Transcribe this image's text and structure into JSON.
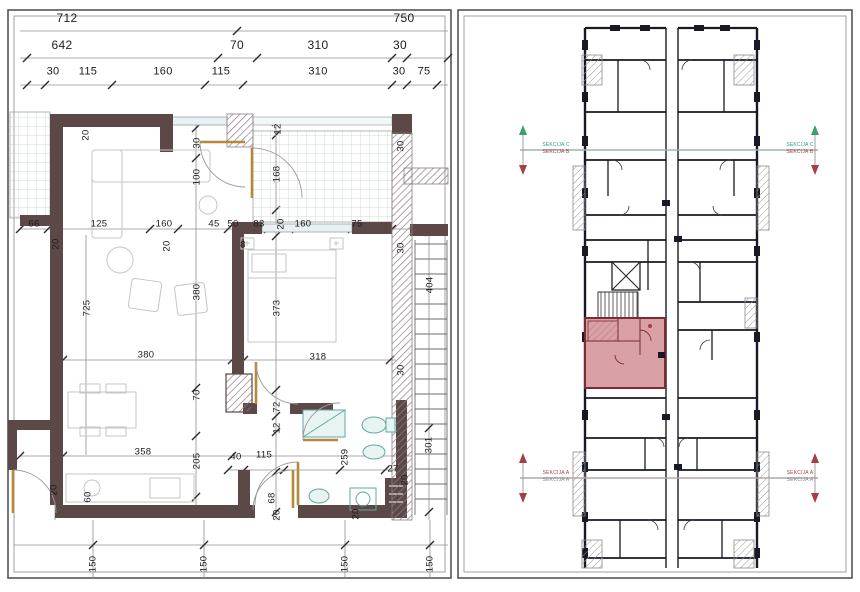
{
  "page": {
    "background": "#ffffff",
    "type": "architectural-floor-plan"
  },
  "colors": {
    "wall_dark": "#5c4847",
    "hatch_line": "#8d7d86",
    "window_fill": "#e8f1f3",
    "door_tan": "#b5883a",
    "fixture_teal": "#5fa8a0",
    "furniture_gray": "#c6c6c6",
    "dim_text": "#1c1c1c",
    "building_wall": "#191925",
    "highlight_fill": "#d9a1a6",
    "highlight_border": "#7c2b33",
    "section_teal": "#2f9a8c",
    "section_red": "#a43f47"
  },
  "left_panel": {
    "name": "apartment-floor-plan",
    "labels": [
      {
        "t": "712",
        "x": 67,
        "y": 18,
        "fs": 12
      },
      {
        "t": "750",
        "x": 404,
        "y": 18,
        "fs": 12
      },
      {
        "t": "642",
        "x": 62,
        "y": 45,
        "fs": 12
      },
      {
        "t": "70",
        "x": 237,
        "y": 45,
        "fs": 12
      },
      {
        "t": "310",
        "x": 318,
        "y": 45,
        "fs": 12
      },
      {
        "t": "30",
        "x": 400,
        "y": 45,
        "fs": 12
      },
      {
        "t": "30",
        "x": 53,
        "y": 72,
        "fs": 11
      },
      {
        "t": "115",
        "x": 88,
        "y": 72,
        "fs": 11
      },
      {
        "t": "160",
        "x": 163,
        "y": 72,
        "fs": 11
      },
      {
        "t": "115",
        "x": 221,
        "y": 72,
        "fs": 11
      },
      {
        "t": "310",
        "x": 318,
        "y": 72,
        "fs": 11
      },
      {
        "t": "30",
        "x": 399,
        "y": 72,
        "fs": 11
      },
      {
        "t": "75",
        "x": 424,
        "y": 72,
        "fs": 11
      },
      {
        "t": "20",
        "x": 86,
        "y": 135,
        "r": 1
      },
      {
        "t": "12",
        "x": 278,
        "y": 129,
        "r": 1
      },
      {
        "t": "30",
        "x": 401,
        "y": 146,
        "r": 1
      },
      {
        "t": "30",
        "x": 197,
        "y": 143,
        "r": 1
      },
      {
        "t": "100",
        "x": 197,
        "y": 177,
        "r": 1
      },
      {
        "t": "168",
        "x": 277,
        "y": 174,
        "r": 1
      },
      {
        "t": "66",
        "x": 34,
        "y": 224
      },
      {
        "t": "125",
        "x": 99,
        "y": 224
      },
      {
        "t": "160",
        "x": 164,
        "y": 224
      },
      {
        "t": "45",
        "x": 214,
        "y": 224
      },
      {
        "t": "50",
        "x": 233,
        "y": 224
      },
      {
        "t": "83",
        "x": 259,
        "y": 224
      },
      {
        "t": "20",
        "x": 281,
        "y": 224,
        "r": 1
      },
      {
        "t": "160",
        "x": 303,
        "y": 224
      },
      {
        "t": "75",
        "x": 357,
        "y": 224
      },
      {
        "t": "8",
        "x": 243,
        "y": 245
      },
      {
        "t": "20",
        "x": 56,
        "y": 244,
        "r": 1
      },
      {
        "t": "20",
        "x": 167,
        "y": 246,
        "r": 1
      },
      {
        "t": "30",
        "x": 401,
        "y": 248,
        "r": 1
      },
      {
        "t": "725",
        "x": 87,
        "y": 308,
        "r": 1
      },
      {
        "t": "380",
        "x": 197,
        "y": 292,
        "r": 1
      },
      {
        "t": "373",
        "x": 277,
        "y": 308,
        "r": 1
      },
      {
        "t": "404",
        "x": 430,
        "y": 285,
        "r": 1
      },
      {
        "t": "380",
        "x": 146,
        "y": 355
      },
      {
        "t": "318",
        "x": 318,
        "y": 357
      },
      {
        "t": "30",
        "x": 401,
        "y": 370,
        "r": 1
      },
      {
        "t": "70",
        "x": 197,
        "y": 395,
        "r": 1
      },
      {
        "t": "72",
        "x": 277,
        "y": 407,
        "r": 1
      },
      {
        "t": "12",
        "x": 277,
        "y": 428,
        "r": 1
      },
      {
        "t": "358",
        "x": 143,
        "y": 452
      },
      {
        "t": "205",
        "x": 197,
        "y": 461,
        "r": 1
      },
      {
        "t": "40",
        "x": 236,
        "y": 457
      },
      {
        "t": "115",
        "x": 264,
        "y": 455
      },
      {
        "t": "259",
        "x": 345,
        "y": 457,
        "r": 1
      },
      {
        "t": "27",
        "x": 393,
        "y": 469
      },
      {
        "t": "301",
        "x": 429,
        "y": 445,
        "r": 1
      },
      {
        "t": "20",
        "x": 405,
        "y": 480,
        "r": 1
      },
      {
        "t": "20",
        "x": 54,
        "y": 490,
        "r": 1
      },
      {
        "t": "60",
        "x": 88,
        "y": 497,
        "r": 1
      },
      {
        "t": "68",
        "x": 272,
        "y": 498,
        "r": 1
      },
      {
        "t": "20",
        "x": 277,
        "y": 515,
        "r": 1
      },
      {
        "t": "20",
        "x": 356,
        "y": 514,
        "r": 1
      },
      {
        "t": "150",
        "x": 93,
        "y": 564,
        "r": 1
      },
      {
        "t": "150",
        "x": 204,
        "y": 564,
        "r": 1
      },
      {
        "t": "150",
        "x": 345,
        "y": 564,
        "r": 1
      },
      {
        "t": "150",
        "x": 430,
        "y": 564,
        "r": 1
      }
    ]
  },
  "right_panel": {
    "name": "building-key-plan",
    "highlight_unit": "selected-apartment",
    "section_markers": [
      {
        "x": 556,
        "y": 149,
        "lines": [
          {
            "t": "SEKCIJA C",
            "c": "#2f9a8c"
          },
          {
            "t": "SEKCIJA B",
            "c": "#a43f47"
          }
        ]
      },
      {
        "x": 800,
        "y": 149,
        "lines": [
          {
            "t": "SEKCIJA C",
            "c": "#2f9a8c"
          },
          {
            "t": "SEKCIJA B",
            "c": "#a43f47"
          }
        ]
      },
      {
        "x": 556,
        "y": 477,
        "lines": [
          {
            "t": "SEKCIJA A",
            "c": "#a43f47"
          },
          {
            "t": "SEKCIJA A",
            "c": "#8a8a8a"
          }
        ]
      },
      {
        "x": 800,
        "y": 477,
        "lines": [
          {
            "t": "SEKCIJA A",
            "c": "#a43f47"
          },
          {
            "t": "SEKCIJA A",
            "c": "#8a8a8a"
          }
        ]
      }
    ]
  }
}
